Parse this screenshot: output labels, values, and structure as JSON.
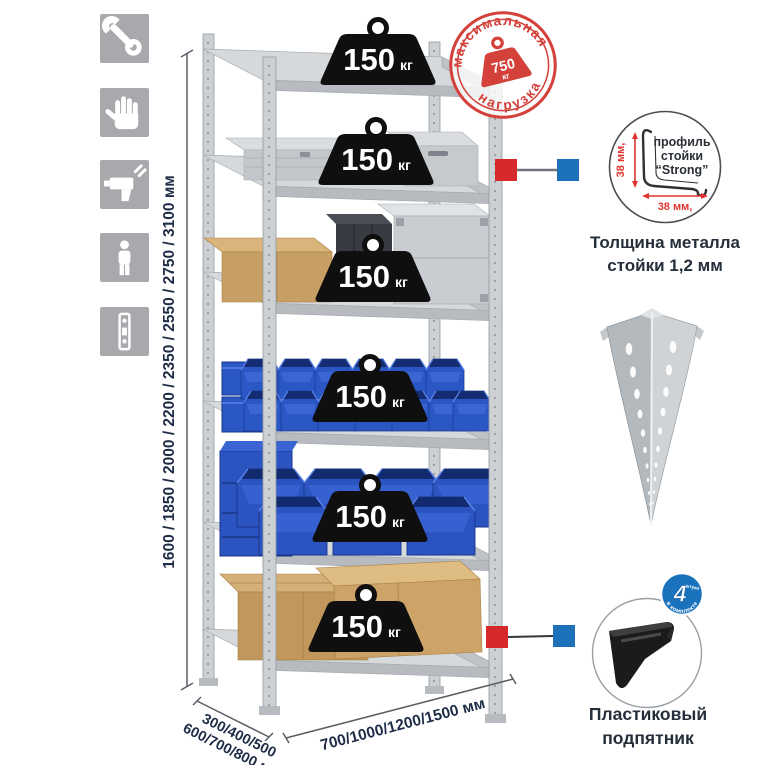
{
  "page": {
    "background": "#ffffff"
  },
  "colors": {
    "accent_red": "#d7282c",
    "accent_blue": "#1d71b8",
    "stamp_red": "#d4403a",
    "dimension_navy": "#1f2c47",
    "bin_blue": "#2b57c4",
    "icon_tile_gray": "#a7a9ac"
  },
  "left_icons": [
    {
      "name": "wrench-icon"
    },
    {
      "name": "gloves-icon"
    },
    {
      "name": "drill-icon"
    },
    {
      "name": "person-icon"
    },
    {
      "name": "perforated-profile-icon"
    }
  ],
  "dimensions": {
    "height": "1600 / 1850 / 2000 / 2200 / 2350 / 2550 / 2750 / 3100 мм",
    "depth_line1": "300/400/500",
    "depth_line2": "600/700/800 мм",
    "width": "700/1000/1200/1500 мм"
  },
  "weights": [
    {
      "value": "150",
      "unit": "кг"
    },
    {
      "value": "150",
      "unit": "кг"
    },
    {
      "value": "150",
      "unit": "кг"
    },
    {
      "value": "150",
      "unit": "кг"
    },
    {
      "value": "150",
      "unit": "кг"
    },
    {
      "value": "150",
      "unit": "кг"
    }
  ],
  "max_load_stamp": {
    "arc_top": "максимальная",
    "arc_bottom": "нагрузка",
    "value": "750",
    "unit": "кг"
  },
  "profile_detail": {
    "line1": "профиль",
    "line2": "стойки",
    "line3": "“Strong”",
    "dim_vertical": "38 мм,",
    "dim_horizontal": "38 мм,",
    "caption_line1": "Толщина металла",
    "caption_line2": "стойки 1,2 мм"
  },
  "foot_detail": {
    "caption_line1": "Пластиковый",
    "caption_line2": "подпятник",
    "badge_value": "4",
    "badge_unit": "штуки",
    "badge_arc": "в комплекте"
  }
}
